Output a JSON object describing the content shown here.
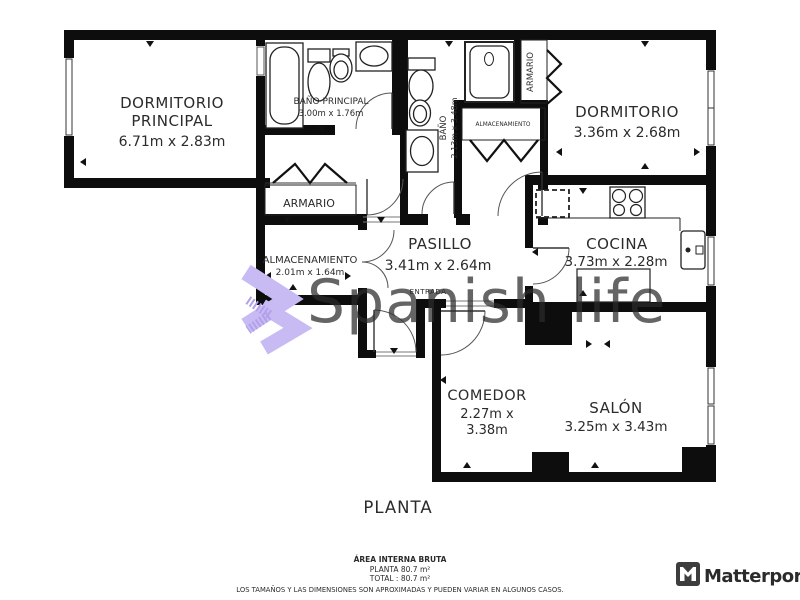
{
  "page": {
    "background": "#ffffff"
  },
  "watermark": {
    "text": "Spanish life",
    "text_color": "#a6a6a6",
    "logo_color": "#c8baf2",
    "logo_accent_color": "#b2a0ec"
  },
  "plan_title": {
    "label": "PLANTA"
  },
  "rooms": {
    "dormitorio_principal": {
      "name_line1": "DORMITORIO",
      "name_line2": "PRINCIPAL",
      "dims": "6.71m x 2.83m"
    },
    "bano_principal": {
      "name": "BAÑO PRINCIPAL",
      "dims": "3.00m x 1.76m"
    },
    "bano": {
      "name": "BAÑO",
      "dims": "2.13m x 3.48m"
    },
    "armario_superior": {
      "name": "ARMARIO"
    },
    "almacenamiento_pequeno": {
      "name": "ALMACENAMIENTO"
    },
    "dormitorio": {
      "name": "DORMITORIO",
      "dims": "3.36m x 2.68m"
    },
    "armario": {
      "name": "ARMARIO"
    },
    "almacenamiento": {
      "name": "ALMACENAMIENTO",
      "dims": "2.01m x 1.64m"
    },
    "pasillo": {
      "name": "PASILLO",
      "dims": "3.41m x 2.64m",
      "entry_label": "ENTRADA"
    },
    "cocina": {
      "name": "COCINA",
      "dims": "3.73m x 2.28m"
    },
    "comedor": {
      "name": "COMEDOR",
      "dims_line1": "2.27m x",
      "dims_line2": "3.38m"
    },
    "salon": {
      "name": "SALÓN",
      "dims": "3.25m x 3.43m"
    }
  },
  "footer": {
    "area_heading": "ÁREA INTERNA BRUTA",
    "planta_area": "PLANTA 80.7 m²",
    "total_area": "TOTAL :  80.7 m²",
    "disclaimer": "LOS TAMAÑOS Y LAS DIMENSIONES SON APROXIMADAS Y PUEDEN VARIAR EN ALGUNOS CASOS."
  },
  "brand": {
    "name": "Matterport",
    "color": "#3d3d3d"
  }
}
